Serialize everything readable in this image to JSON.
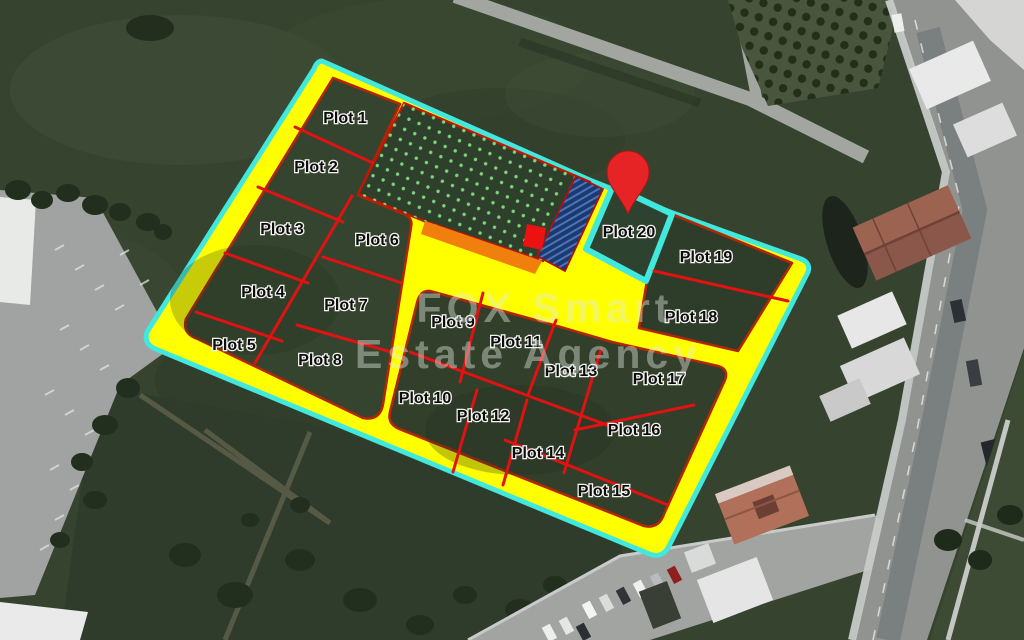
{
  "watermark": {
    "line1": "FOX Smart",
    "line2": "Estate Agency"
  },
  "map": {
    "description": "satellite-plot-subdivision-overlay",
    "plots": [
      {
        "label": "Plot 1",
        "x": 345,
        "y": 119
      },
      {
        "label": "Plot 2",
        "x": 316,
        "y": 168
      },
      {
        "label": "Plot 3",
        "x": 282,
        "y": 230
      },
      {
        "label": "Plot 4",
        "x": 263,
        "y": 293
      },
      {
        "label": "Plot 5",
        "x": 234,
        "y": 346
      },
      {
        "label": "Plot 6",
        "x": 377,
        "y": 241
      },
      {
        "label": "Plot 7",
        "x": 346,
        "y": 306
      },
      {
        "label": "Plot 8",
        "x": 320,
        "y": 361
      },
      {
        "label": "Plot 9",
        "x": 453,
        "y": 323
      },
      {
        "label": "Plot 10",
        "x": 425,
        "y": 399
      },
      {
        "label": "Plot 11",
        "x": 516,
        "y": 343
      },
      {
        "label": "Plot 12",
        "x": 483,
        "y": 417
      },
      {
        "label": "Plot 13",
        "x": 571,
        "y": 372
      },
      {
        "label": "Plot 14",
        "x": 538,
        "y": 454
      },
      {
        "label": "Plot 15",
        "x": 604,
        "y": 492
      },
      {
        "label": "Plot 16",
        "x": 634,
        "y": 431
      },
      {
        "label": "Plot 17",
        "x": 659,
        "y": 380
      },
      {
        "label": "Plot 18",
        "x": 691,
        "y": 318
      },
      {
        "label": "Plot 19",
        "x": 706,
        "y": 258
      },
      {
        "label": "Plot 20",
        "x": 629,
        "y": 233
      }
    ]
  },
  "colors": {
    "road_overlay": "#ffff00",
    "boundary": "#40e8de",
    "plot_line": "#e01212",
    "block_border": "#b02606",
    "green_dot": "#7dd47a",
    "reserved_navy": "#1d3a70",
    "navy_hatch": "#4a74b8",
    "orange_strip": "#f07f0e",
    "pin_red": "#e62425",
    "marker_red": "#ec1212",
    "label_text": "#0d0d0d",
    "watermark": "#e3eae3"
  }
}
